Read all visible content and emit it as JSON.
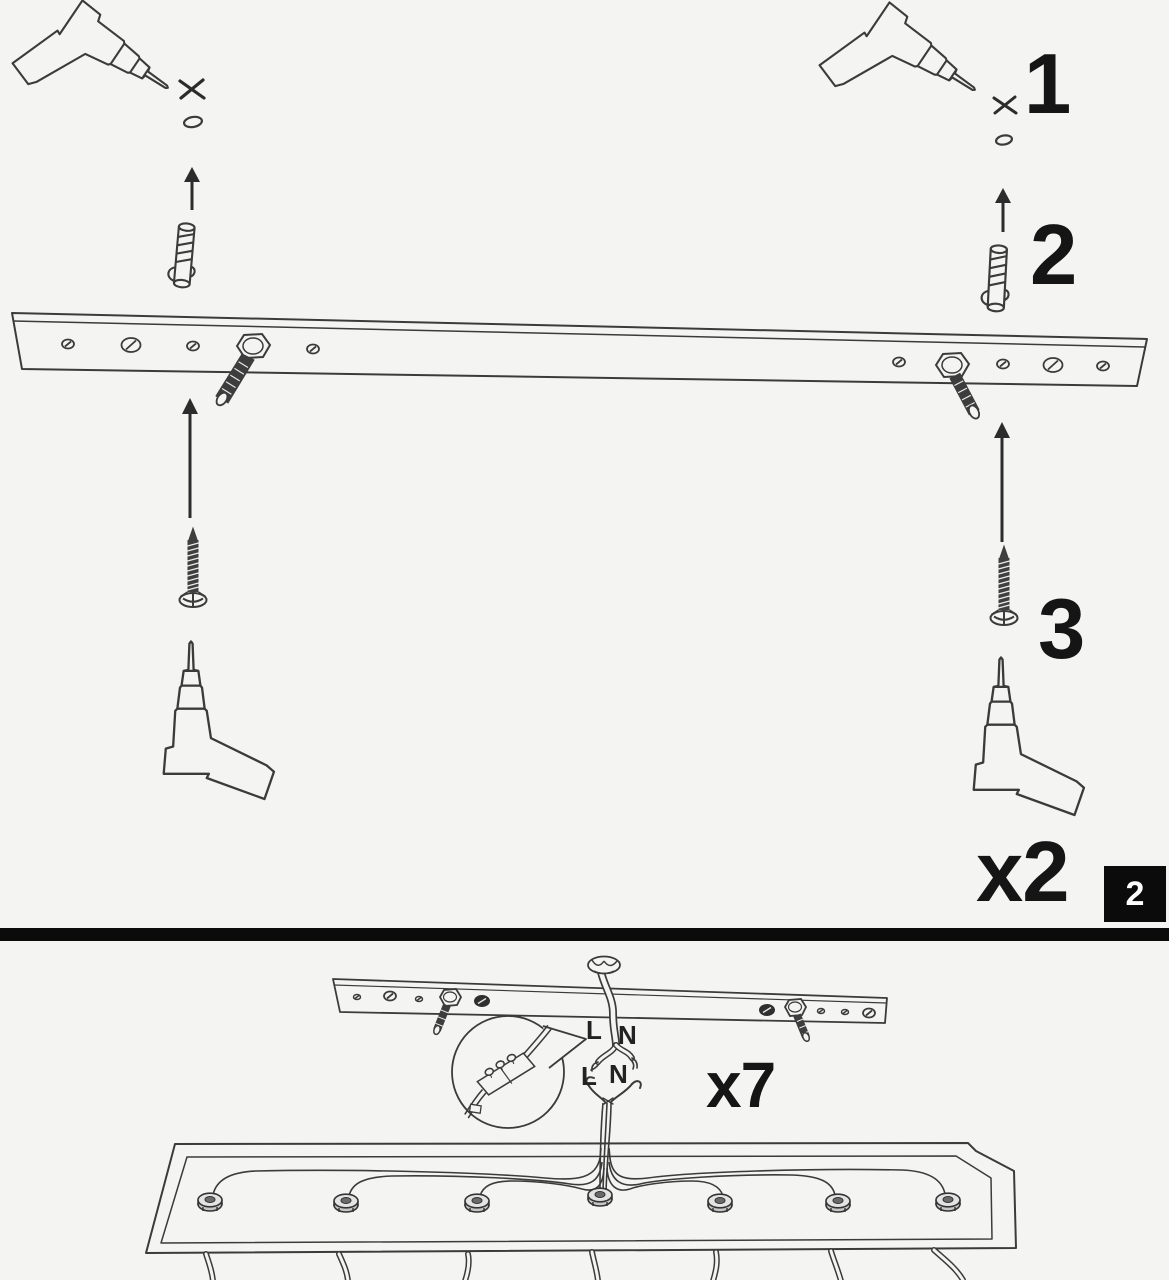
{
  "colors": {
    "background": "#f4f4f3",
    "line": "#3b3b3b",
    "text": "#151515",
    "divider": "#0b0b0b",
    "badge_bg": "#0b0b0b",
    "badge_text": "#ffffff"
  },
  "top_section": {
    "steps": [
      "1",
      "2",
      "3"
    ],
    "quantity_label": "x2",
    "page_badge": "2",
    "icons": [
      "power-drill",
      "cross-mark",
      "drilled-hole",
      "arrow-up",
      "wall-plug",
      "mounting-bar",
      "threaded-stud",
      "wood-screw",
      "electric-screwdriver"
    ]
  },
  "bottom_section": {
    "quantity_label": "x7",
    "wiring": {
      "ceiling_live": "L",
      "ceiling_neutral": "N",
      "fixture_live": "L",
      "fixture_neutral": "N"
    },
    "icons": [
      "mounting-bar-installed",
      "ceiling-cable",
      "terminal-block-callout",
      "canopy-base",
      "cable-gland",
      "pendant-cables"
    ]
  }
}
